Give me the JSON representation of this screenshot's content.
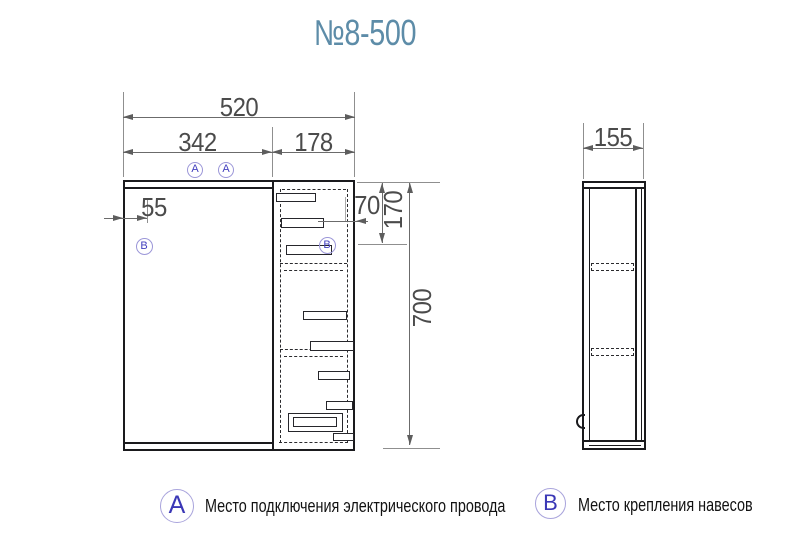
{
  "title": "№8-500",
  "front_view": {
    "dim_width_total": "520",
    "dim_width_mirror": "342",
    "dim_width_cabinet": "178",
    "dim_hanger_offset": "55",
    "dim_top_offset": "70",
    "dim_hanger_top": "170",
    "dim_height_total": "700"
  },
  "side_view": {
    "dim_depth": "155"
  },
  "markers": {
    "a": "A",
    "b": "B"
  },
  "legend": [
    {
      "marker": "A",
      "text": "Место подключения электрического провода"
    },
    {
      "marker": "B",
      "text": "Место крепления навесов"
    }
  ],
  "colors": {
    "title": "#5d8ca8",
    "marker_letter": "#4340bf",
    "marker_circle": "#9b96d8",
    "drawing_line": "#1a1a1d",
    "dimension": "#4b4b4b"
  }
}
